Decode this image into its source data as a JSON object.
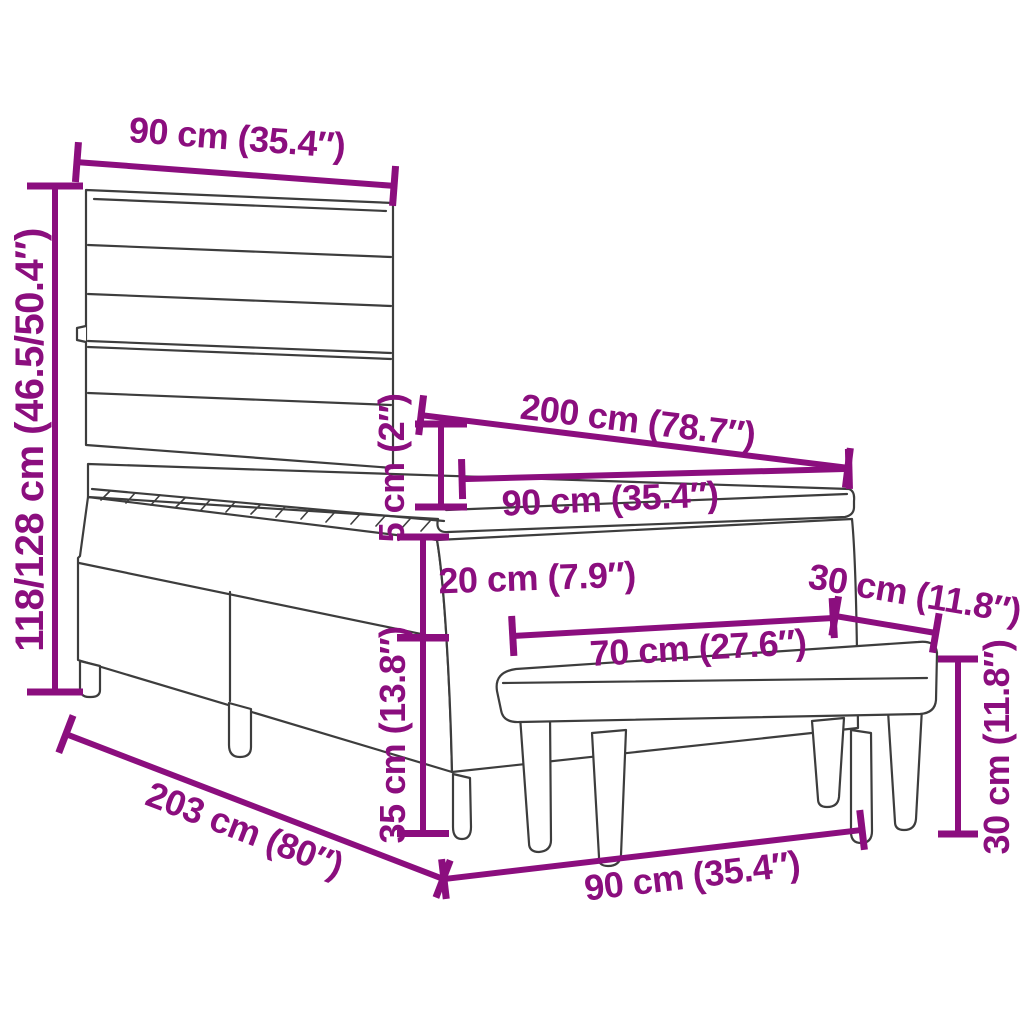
{
  "diagram": {
    "type": "furniture-dimension-diagram",
    "subject": "box spring bed with headboard and bench",
    "colors": {
      "dimension_accent": "#8B0E7E",
      "furniture_outline": "#3D3D3D",
      "background": "#FFFFFF"
    },
    "dimensions": {
      "headboard_width": "90 cm (35.4″)",
      "height_range": "118/128 cm (46.5/50.4″)",
      "bed_length": "200 cm (78.7″)",
      "mattress_width": "90 cm (35.4″)",
      "mattress_thickness": "5 cm (2″)",
      "box_section_height": "20 cm (7.9″)",
      "base_height": "35 cm (13.8″)",
      "bench_length": "70 cm (27.6″)",
      "bench_depth": "30 cm (11.8″)",
      "bench_height": "30 cm (11.8″)",
      "frame_length": "203 cm (80″)",
      "frame_width": "90 cm (35.4″)"
    }
  }
}
